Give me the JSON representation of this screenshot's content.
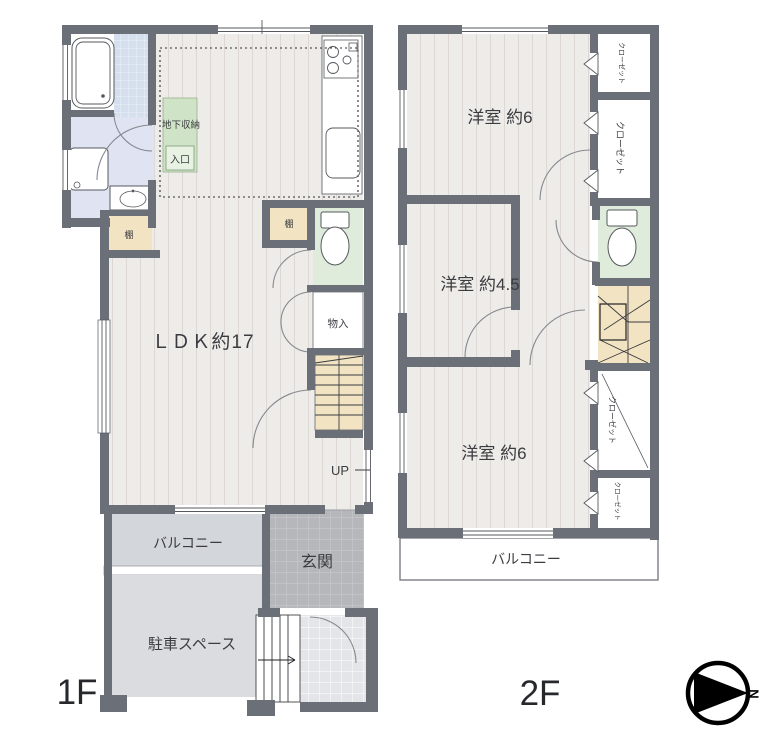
{
  "floor1": {
    "label": "1F",
    "ldk": "ＬＤＫ約17",
    "basement_storage": "地下収納",
    "basement_entrance": "入口",
    "shelf_left": "棚",
    "shelf_right": "棚",
    "storage": "物入",
    "stairs_up": "UP",
    "balcony": "バルコニー",
    "entrance_hall": "玄関",
    "parking": "駐車スペース"
  },
  "floor2": {
    "label": "2F",
    "bedroom_top": "洋室 約6",
    "bedroom_middle": "洋室 約4.5",
    "bedroom_bottom": "洋室 約6",
    "closet_top": "クローゼット",
    "closet_upper": "クローゼット",
    "closet_lower": "クローゼット",
    "closet_bottom": "クローゼット",
    "balcony": "バルコニー"
  },
  "compass": {
    "north": "N"
  },
  "colors": {
    "wall": "#6b6f77",
    "floor_wood": "#eeece9",
    "floor_stripe": "#ddd8d3",
    "stair_tan": "#f2e4c3",
    "toilet_green": "#dfecdb",
    "washroom_blue": "#e0e3f1",
    "bath_tile": "#d6dfee",
    "balcony_gray": "#d3d6da",
    "parking_gray": "#dadce0",
    "genkan_gray": "#b5b7bb",
    "porch_gray": "#e3e5e8",
    "storage_green": "#cfe3c6",
    "text": "#3a3c40"
  }
}
